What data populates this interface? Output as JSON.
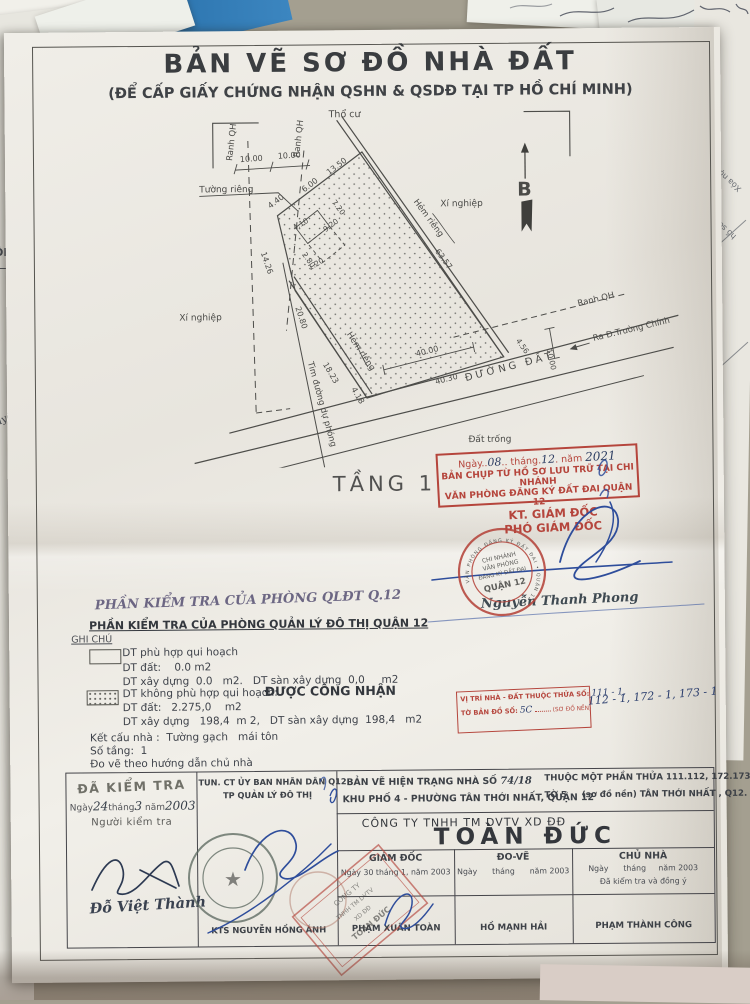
{
  "colors": {
    "stamp_red": "#b5453c",
    "ink_blue": "#2e4d9b",
    "paper": "#edeae4",
    "desk": "#a49f90"
  },
  "icons": {
    "star": "★"
  },
  "header": {
    "title": "BẢN VẼ SƠ ĐỒ NHÀ ĐẤT",
    "subtitle": "(ĐỂ CẤP GIẤY CHỨNG NHẬN QSHN & QSDĐ TẠI TP HỒ CHÍ MINH)"
  },
  "map": {
    "tho_cu": "Thổ cư",
    "north_b": "B",
    "xi_nghiep_right": "Xí nghiệp",
    "xi_nghiep_left": "Xí nghiệp",
    "ranh_qh_left1": "Ranh QH",
    "ranh_qh_left2": "Ranh QH",
    "ranh_qh_right": "Ranh QH",
    "tuong_rieng": "Tường riêng",
    "hem_rieng_right": "Hẻm riêng",
    "hem_rieng_left": "Hẻm riêng",
    "tim_duong": "Tim đường dự phóng",
    "duong_dat": "ĐƯỜNG ĐẤT",
    "dat_trong": "Đất trống",
    "ra_duong": "Ra Đ.Trường Chính",
    "dims": {
      "w10a": "10.00",
      "w10b": "10.00",
      "d13_50": "13.50",
      "d6": "6.00",
      "d7_20": "7.20",
      "d4_40": "4.40",
      "d4_10": "4.10",
      "d9_20": "9.20",
      "d2_80": "2.80",
      "d1_20": "1.20",
      "d14_26": "14.26",
      "d20_80": "20.80",
      "d18_23": "18.23",
      "d4_18": "4.18",
      "d63_57": "63.57",
      "d40_00": "40.00",
      "d40_30": "40.30",
      "d4_56": "4.56",
      "d10_right": "10.00"
    }
  },
  "floor_label": "TẦNG 1",
  "archive_stamp": {
    "ngay": "Ngày",
    "day": "08",
    "thang": "tháng",
    "month": "12",
    "nam": "năm",
    "year": "2021",
    "line2": "BẢN CHỤP TỪ HỒ SƠ LƯU TRỮ TẠI CHI NHÁNH",
    "line3": "VĂN PHÒNG ĐĂNG KÝ ĐẤT ĐAI QUẬN 12"
  },
  "approval": {
    "kt": "KT. GIÁM ĐỐC",
    "pho": "PHÓ GIÁM ĐỐC",
    "name": "Nguyễn Thanh Phong",
    "stamp_line1": "CHI NHÁNH",
    "stamp_line2": "VĂN PHÒNG",
    "stamp_line3": "ĐĂNG KÝ ĐẤT ĐAI",
    "stamp_center": "QUẬN 12",
    "stamp_ring": "VĂN PHÒNG ĐĂNG KÝ ĐẤT ĐAI • QUẬN 12 •"
  },
  "inspection": {
    "stamp_title": "PHẦN KIỂM TRA CỦA PHÒNG QLĐT Q.12",
    "title": "PHẦN KIỂM TRA CỦA PHÒNG QUẢN LÝ ĐÔ THỊ QUẬN 12",
    "ghi_chu": "GHI CHÚ",
    "item1_line1": "DT phù hợp qui hoạch",
    "item1_line2": "DT đất:    0.0 m2",
    "item1_line3": "DT xây dựng  0.0   m2.   DT sàn xây dựng  0,0     m2",
    "item2_line1": "DT không phù hợp qui hoạch:",
    "item2_ok": "ĐƯỢC CÔNG NHẬN",
    "item2_line2": "DT đất:   2.275,0    m2",
    "item2_line3": "DT xây dựng   198,4  m 2,   DT sàn xây dựng  198,4   m2",
    "ket_cau": "Kết cấu nhà :  Tường gạch   mái tôn",
    "so_tang": "Số tầng:  1",
    "do_ve": "Đo vẽ theo hướng dẫn chủ nhà"
  },
  "location_box": {
    "line1_label": "VỊ TRÍ NHÀ - ĐẤT THUỘC THỬA SỐ:",
    "line1_hw": "111 - 1,",
    "line1_hw_cont": "112 - 1, 172 - 1, 173 - 1",
    "line2_label": "TỜ BẢN ĐỒ SỐ:",
    "line2_hw": "5C",
    "line2_suffix": "(SƠ ĐỒ NỀN)"
  },
  "table": {
    "checked_stamp": "ĐÃ KIỂM TRA",
    "date_prefix": "Ngày",
    "hw_day": "24",
    "date_mid": "tháng",
    "hw_month": "3",
    "date_mid2": "năm",
    "hw_year": "2003",
    "nguoi_kiem_tra": "Người kiểm tra",
    "inspector_name": "Đỗ Việt Thành",
    "col2_line1": "TUN. CT ỦY BAN NHÂN DÂN Q12",
    "col2_line2": "TP QUẢN LÝ ĐÔ THỊ",
    "col2_name": "KTS NGUYỄN HỒNG ÁNH",
    "header_left_line1": "BẢN VẼ HIỆN TRẠNG NHÀ SỐ",
    "header_left_no": "74/18",
    "header_left_line2": "KHU PHỐ 4 -  PHƯỜNG TÂN THỚI NHẤT, QUẬN 12",
    "header_right_line1": "THUỘC MỘT PHẦN THỬA 111.112, 172.173",
    "header_right_line2": "TỜ 5     (sơ đồ nền) TÂN THỚI NHẤT , Q12.",
    "company": "CÔNG TY TNHH TM DVTV XD ĐĐ",
    "company_name": "TOÀN ĐỨC",
    "cols": [
      {
        "title": "GIÁM ĐỐC",
        "date": "Ngày 30 tháng 1, năm 2003",
        "name": "PHẠM XUÂN TOÀN"
      },
      {
        "title": "ĐO-VẼ",
        "date": "Ngày      tháng      năm 2003",
        "name": "HỒ MẠNH HẢI"
      },
      {
        "title": "CHỦ NHÀ",
        "date": "Ngày      tháng     năm 2003",
        "note": "Đã kiểm tra và đồng ý",
        "name": "PHẠM THÀNH CÔNG"
      }
    ]
  },
  "company_stamp": {
    "l1": "CÔNG TY",
    "l2": "TNHH TM DVTV",
    "l3": "XD ĐĐ",
    "l4": "TOÀN ĐỨC"
  },
  "background": {
    "frag1": "Xóa nội dung",
    "frag2": "hồ sơ số",
    "frag3": "Nội",
    "frag4": "Vị-",
    "frag_left1": "ỘN",
    "frag_left2": "uyề"
  }
}
